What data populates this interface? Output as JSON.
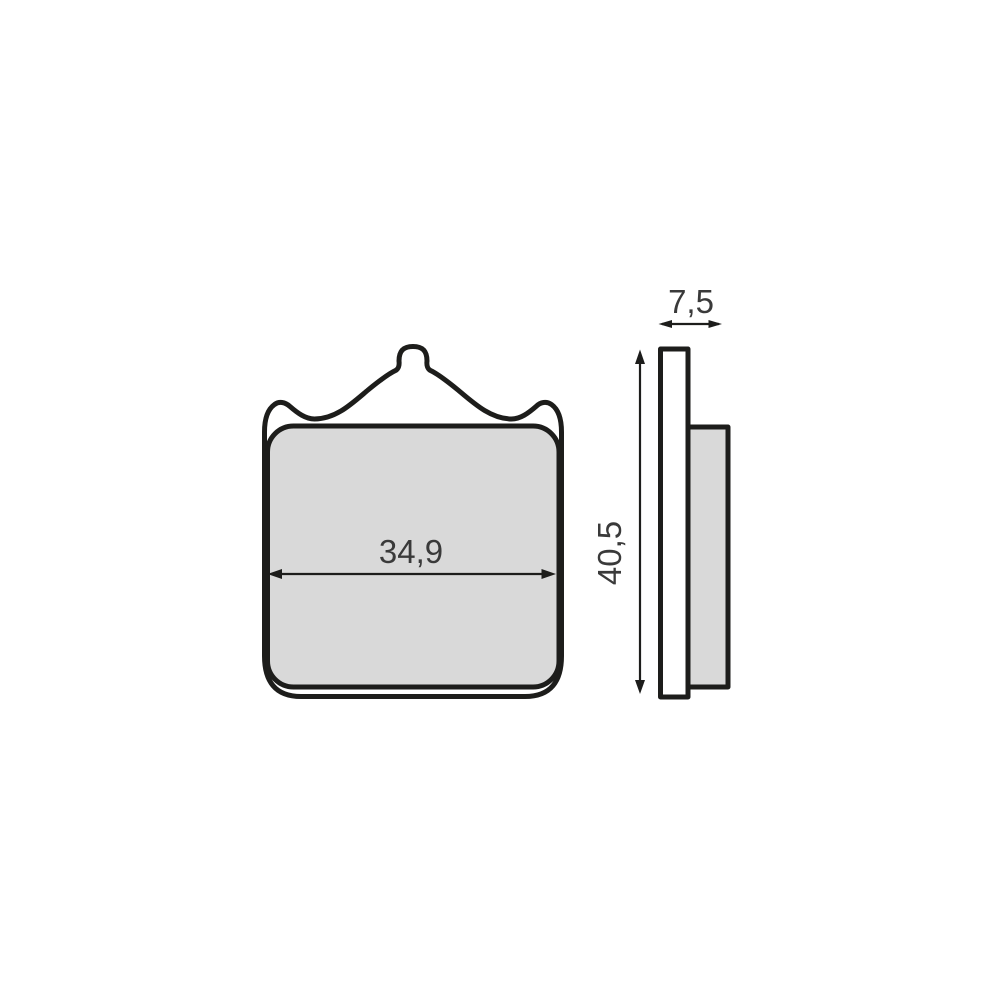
{
  "diagram": {
    "type": "technical-drawing",
    "subject": "brake-pad-two-view-drawing",
    "dimensions": {
      "front_width": "34,9",
      "side_height": "40,5",
      "side_thickness": "7,5"
    },
    "colors": {
      "line": "#1d1d1b",
      "pad_fill": "#d9d9d9",
      "plate_fill": "#ffffff",
      "dimension_text": "#3a3a3a",
      "background": "#ffffff"
    }
  }
}
